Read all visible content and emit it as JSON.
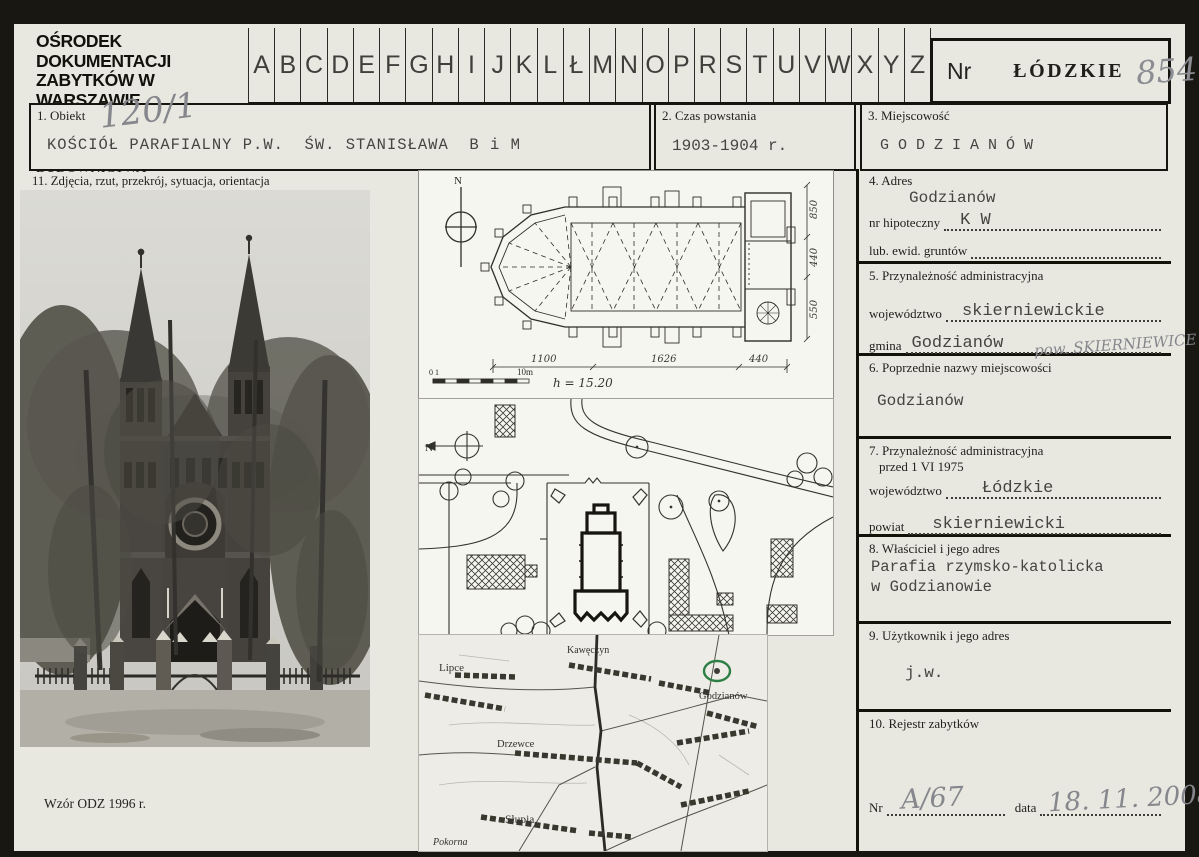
{
  "header": {
    "org_line1": "OŚRODEK DOKUMENTACJI",
    "org_line2": "ZABYTKÓW W WARSZAWIE",
    "org_line3": "KARTA EWIDENCYJNA ZABYTKÓW",
    "org_line4": "ARCHITEKTURY I BUDOWNICTWA",
    "alphabet": [
      "A",
      "B",
      "C",
      "D",
      "E",
      "F",
      "G",
      "H",
      "I",
      "J",
      "K",
      "L",
      "Ł",
      "M",
      "N",
      "O",
      "P",
      "R",
      "S",
      "T",
      "U",
      "V",
      "W",
      "X",
      "Y",
      "Z"
    ],
    "nr_label": "Nr",
    "voivodeship_stamp": "ŁÓDZKIE",
    "card_number": "854"
  },
  "fields": {
    "f1": {
      "label": "1. Obiekt",
      "annotation": "120/1",
      "value": "KOŚCIÓŁ PARAFIALNY P.W.  ŚW. STANISŁAWA  B i M"
    },
    "f2": {
      "label": "2. Czas powstania",
      "value": "1903-1904 r."
    },
    "f3": {
      "label": "3. Miejscowość",
      "value": "G O D Z I A N Ó W"
    },
    "f4": {
      "label": "4. Adres",
      "value": "Godzianów",
      "row1_label": "nr hipoteczny",
      "row1_value": "K W",
      "row2_label": "lub. ewid. gruntów",
      "row2_value": ""
    },
    "f5": {
      "label": "5. Przynależność administracyjna",
      "row1_label": "województwo",
      "row1_value": "skierniewickie",
      "row2_label": "gmina",
      "row2_value": "Godzianów",
      "row2_annotation": "pow. SKIERNIEWICE"
    },
    "f6": {
      "label": "6. Poprzednie nazwy miejscowości",
      "value": "Godzianów"
    },
    "f7": {
      "label_line1": "7. Przynależność administracyjna",
      "label_line2": "przed 1 VI 1975",
      "row1_label": "województwo",
      "row1_value": "Łódzkie",
      "row2_label": "powiat",
      "row2_value": "skierniewicki"
    },
    "f8": {
      "label": "8. Właściciel i jego adres",
      "value_line1": "Parafia rzymsko-katolicka",
      "value_line2": "w Godzianowie"
    },
    "f9": {
      "label": "9. Użytkownik i jego adres",
      "value": "j.w."
    },
    "f10": {
      "label": "10. Rejestr zabytków",
      "nr_label": "Nr",
      "nr_value": "A/67",
      "date_label": "data",
      "date_value": "18. 11. 2008"
    },
    "f11": {
      "label": "11. Zdjęcia, rzut, przekrój, sytuacja, orientacja"
    }
  },
  "floor_plan": {
    "north_label": "N",
    "dim_bottom": [
      "1100",
      "1626",
      "440"
    ],
    "dim_right": [
      "850",
      "440",
      "550"
    ],
    "scale_left": "0 1",
    "scale_right": "10m",
    "height_note": "h = 15.20"
  },
  "site_plan": {
    "north_label": "N"
  },
  "map": {
    "labels": [
      "Lipce",
      "Kawęczyn",
      "Godzianów",
      "Drzewce",
      "Słupia",
      "Pokorna"
    ],
    "highlight_color": "#2d7f45"
  },
  "footer": {
    "note": "Wzór ODZ 1996 r."
  }
}
